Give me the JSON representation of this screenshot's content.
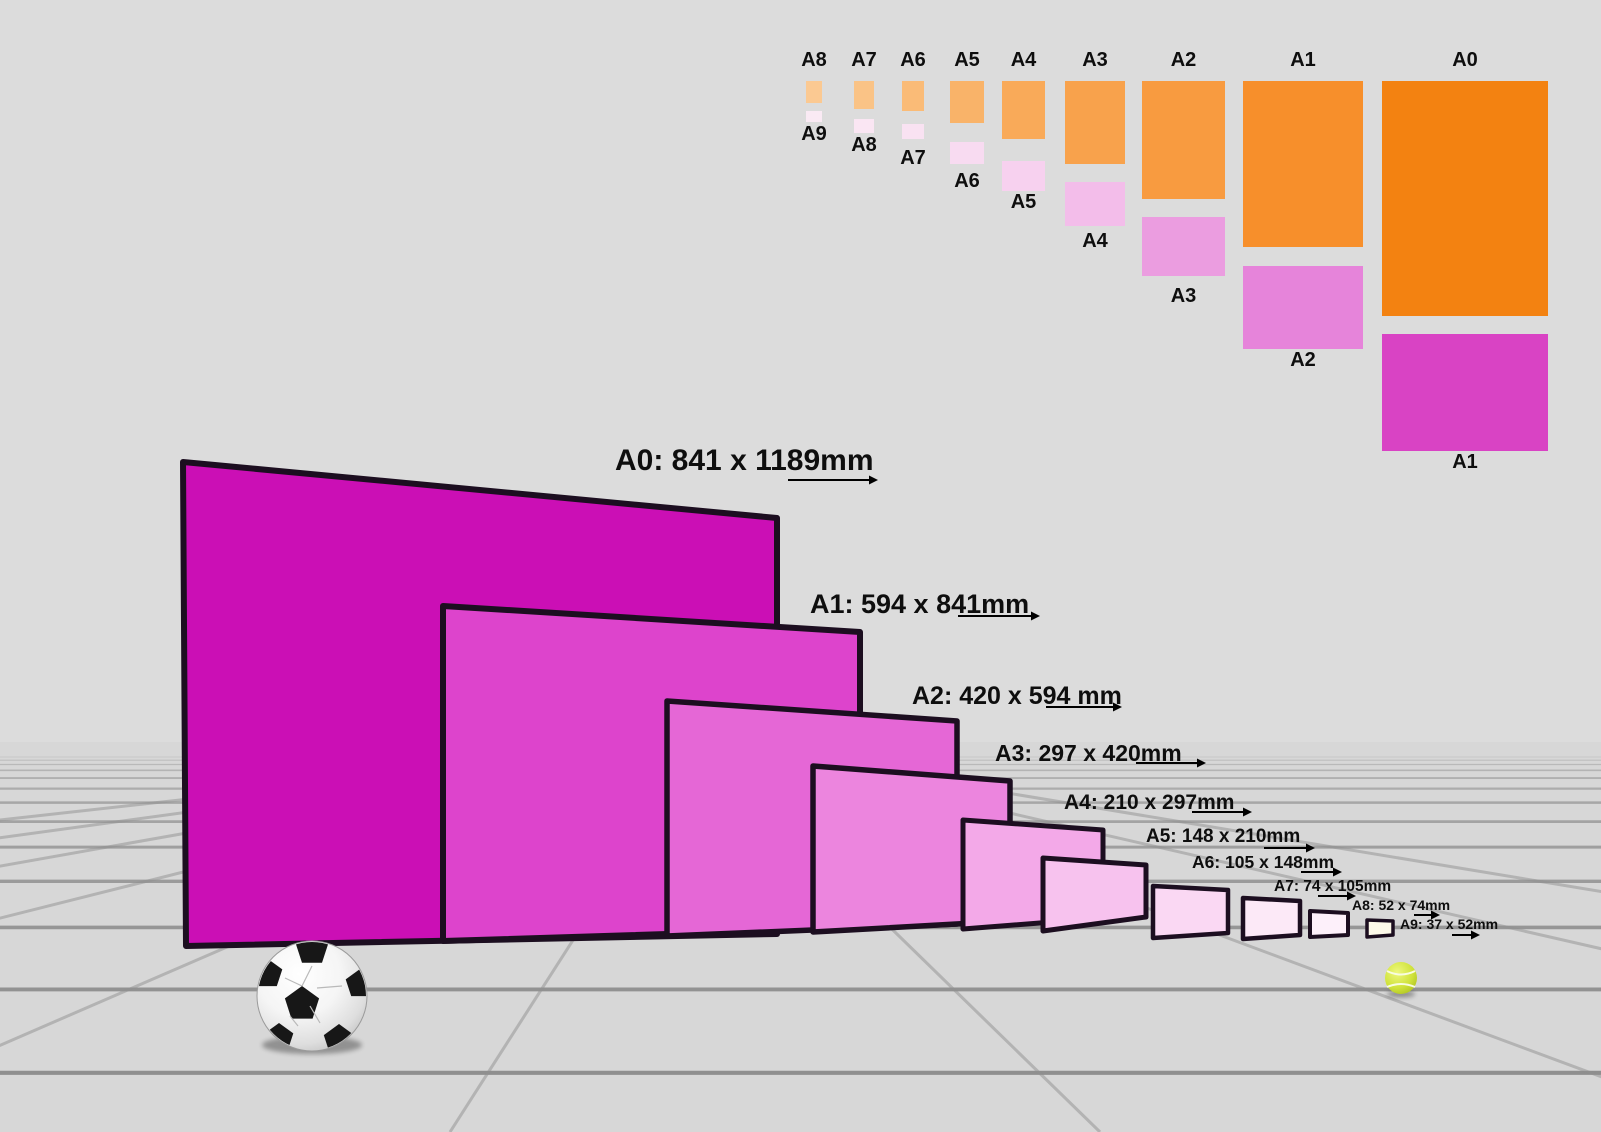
{
  "scene": {
    "background": "#dadada",
    "wall_color": "#dcdcdc",
    "floor_color": "#d7d7d7",
    "grid_line_color": "#8f8f8f",
    "sheet_border_color": "#1c0e20",
    "label_color": "#0e0e0e"
  },
  "size_chart": {
    "columns": [
      {
        "portrait_label": "A8",
        "landscape_label": "A9",
        "portrait_color": "#fbc992",
        "landscape_color": "#faeaf4"
      },
      {
        "portrait_label": "A7",
        "landscape_label": "A8",
        "portrait_color": "#fac386",
        "landscape_color": "#fae6f3"
      },
      {
        "portrait_label": "A6",
        "landscape_label": "A7",
        "portrait_color": "#fabb77",
        "landscape_color": "#f9e2f2"
      },
      {
        "portrait_label": "A5",
        "landscape_label": "A6",
        "portrait_color": "#f9b369",
        "landscape_color": "#f8dbf1"
      },
      {
        "portrait_label": "A4",
        "landscape_label": "A5",
        "portrait_color": "#f9aa59",
        "landscape_color": "#f7d1ef"
      },
      {
        "portrait_label": "A3",
        "landscape_label": "A4",
        "portrait_color": "#f8a24c",
        "landscape_color": "#f3bdea"
      },
      {
        "portrait_label": "A2",
        "landscape_label": "A3",
        "portrait_color": "#f89b40",
        "landscape_color": "#eb9de0"
      },
      {
        "portrait_label": "A1",
        "landscape_label": "A2",
        "portrait_color": "#f78f2b",
        "landscape_color": "#e684da"
      },
      {
        "portrait_label": "A0",
        "landscape_label": "A1",
        "portrait_color": "#f38211",
        "landscape_color": "#d943c4"
      }
    ]
  },
  "sheets": [
    {
      "name": "A0",
      "label": "A0: 841 x 1189mm",
      "width_mm": 841,
      "height_mm": 1189,
      "fill": "#cb0fb5"
    },
    {
      "name": "A1",
      "label": "A1: 594 x 841mm",
      "width_mm": 594,
      "height_mm": 841,
      "fill": "#dd44cc"
    },
    {
      "name": "A2",
      "label": "A2: 420 x 594 mm",
      "width_mm": 420,
      "height_mm": 594,
      "fill": "#e567d6"
    },
    {
      "name": "A3",
      "label": "A3: 297 x 420mm",
      "width_mm": 297,
      "height_mm": 420,
      "fill": "#ec85de"
    },
    {
      "name": "A4",
      "label": "A4: 210 x 297mm",
      "width_mm": 210,
      "height_mm": 297,
      "fill": "#f3a9e8"
    },
    {
      "name": "A5",
      "label": "A5: 148 x 210mm",
      "width_mm": 148,
      "height_mm": 210,
      "fill": "#f7c2ee"
    },
    {
      "name": "A6",
      "label": "A6: 105 x 148mm",
      "width_mm": 105,
      "height_mm": 148,
      "fill": "#fad8f3"
    },
    {
      "name": "A7",
      "label": "A7: 74 x 105mm",
      "width_mm": 74,
      "height_mm": 105,
      "fill": "#fce9f7"
    },
    {
      "name": "A8",
      "label": "A8: 52 x 74mm",
      "width_mm": 52,
      "height_mm": 74,
      "fill": "#fdf0fa"
    },
    {
      "name": "A9",
      "label": "A9: 37 x 52mm",
      "width_mm": 37,
      "height_mm": 52,
      "fill": "#fdf9e9"
    }
  ],
  "objects": {
    "soccer_ball": "soccer-ball",
    "tennis_ball": "tennis-ball"
  }
}
